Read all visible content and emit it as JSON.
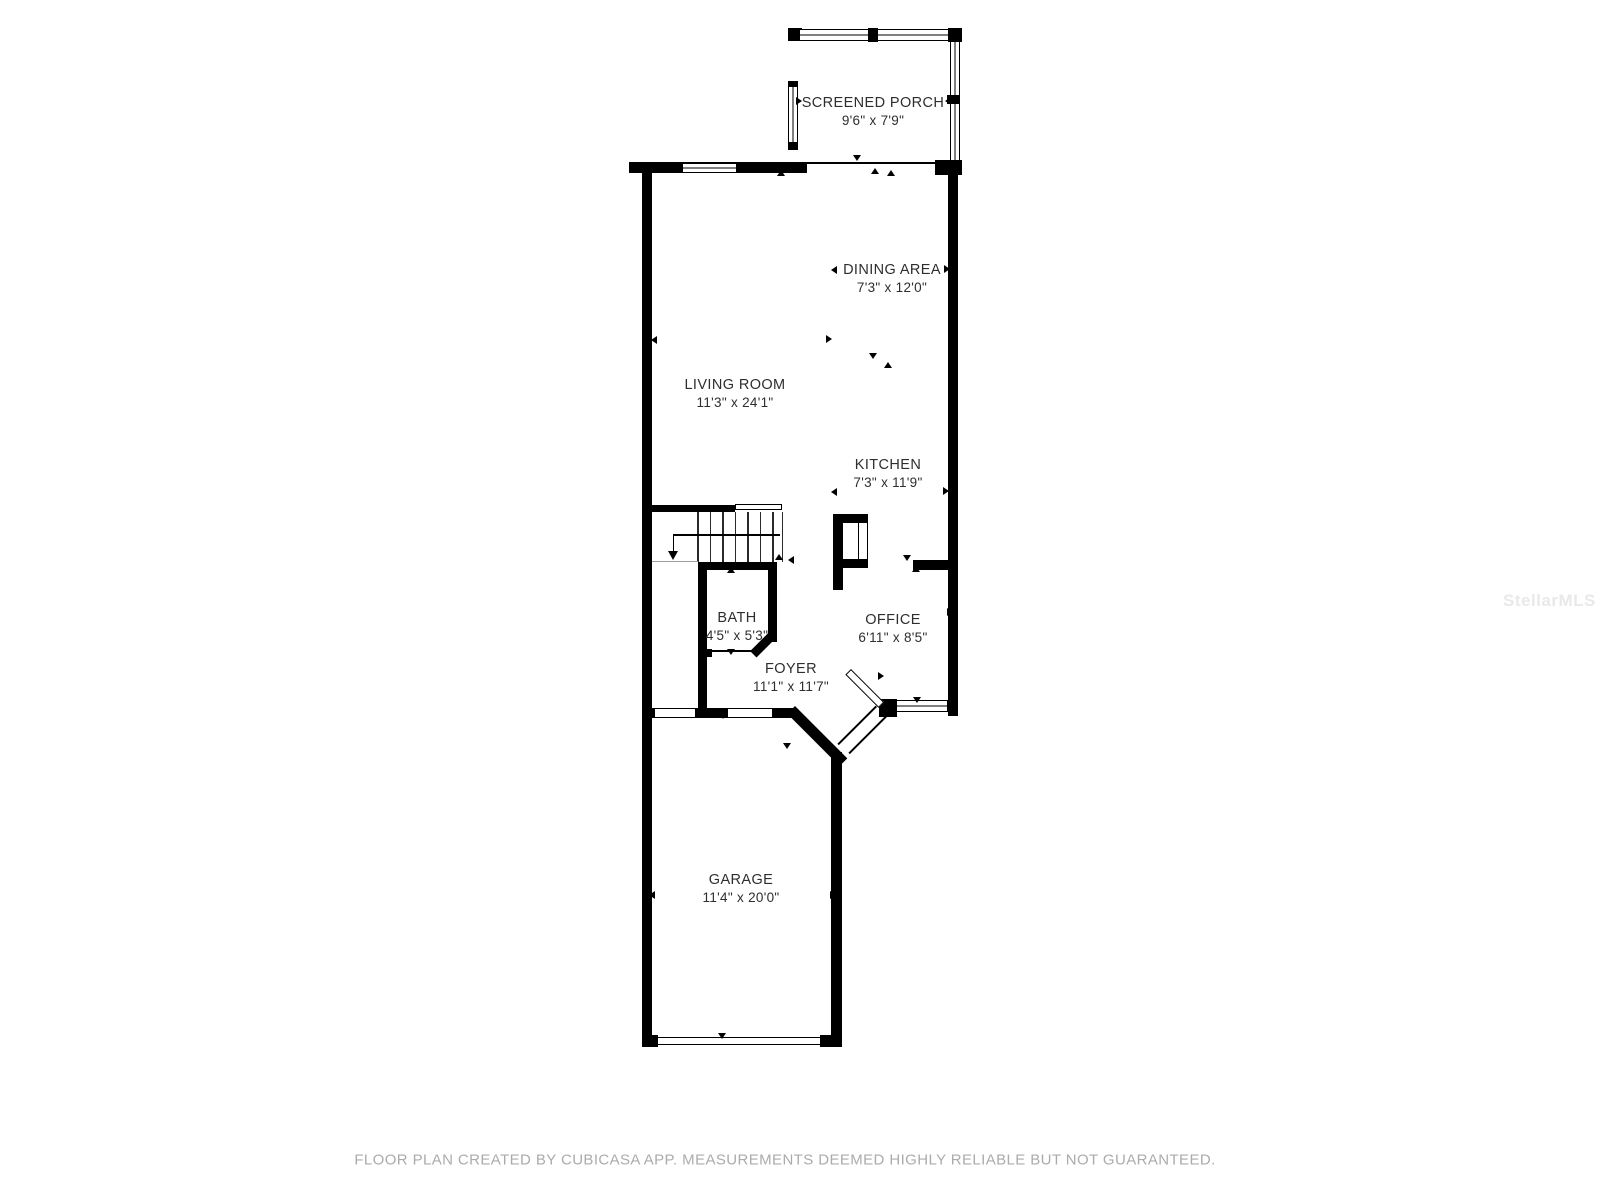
{
  "rooms": [
    {
      "id": "screened-porch",
      "name": "SCREENED PORCH",
      "dims": "9'6\" x 7'9\""
    },
    {
      "id": "dining-area",
      "name": "DINING AREA",
      "dims": "7'3\" x 12'0\""
    },
    {
      "id": "living-room",
      "name": "LIVING ROOM",
      "dims": "11'3\" x 24'1\""
    },
    {
      "id": "kitchen",
      "name": "KITCHEN",
      "dims": "7'3\" x 11'9\""
    },
    {
      "id": "bath",
      "name": "BATH",
      "dims": "4'5\" x 5'3\""
    },
    {
      "id": "office",
      "name": "OFFICE",
      "dims": "6'11\" x 8'5\""
    },
    {
      "id": "foyer",
      "name": "FOYER",
      "dims": "11'1\" x 11'7\""
    },
    {
      "id": "garage",
      "name": "GARAGE",
      "dims": "11'4\" x 20'0\""
    }
  ],
  "watermark": "StellarMLS",
  "footer": "FLOOR PLAN CREATED BY CUBICASA APP. MEASUREMENTS DEEMED HIGHLY RELIABLE BUT NOT GUARANTEED.",
  "colors": {
    "wall": "#000000",
    "label_text": "#2e2e2e",
    "footer_text": "#ababab",
    "watermark_text": "#e9e9e9"
  },
  "markers": [
    {
      "x": 781,
      "y": 173,
      "dir": "up"
    },
    {
      "x": 857,
      "y": 158,
      "dir": "down"
    },
    {
      "x": 875,
      "y": 171,
      "dir": "up"
    },
    {
      "x": 891,
      "y": 173,
      "dir": "up"
    },
    {
      "x": 799,
      "y": 101,
      "dir": "right"
    },
    {
      "x": 948,
      "y": 101,
      "dir": "left"
    },
    {
      "x": 834,
      "y": 270,
      "dir": "left"
    },
    {
      "x": 947,
      "y": 269,
      "dir": "right"
    },
    {
      "x": 654,
      "y": 340,
      "dir": "left"
    },
    {
      "x": 829,
      "y": 339,
      "dir": "right"
    },
    {
      "x": 873,
      "y": 356,
      "dir": "down"
    },
    {
      "x": 888,
      "y": 365,
      "dir": "up"
    },
    {
      "x": 834,
      "y": 492,
      "dir": "left"
    },
    {
      "x": 946,
      "y": 491,
      "dir": "right"
    },
    {
      "x": 779,
      "y": 557,
      "dir": "up"
    },
    {
      "x": 791,
      "y": 560,
      "dir": "left"
    },
    {
      "x": 731,
      "y": 570,
      "dir": "up"
    },
    {
      "x": 731,
      "y": 652,
      "dir": "down"
    },
    {
      "x": 907,
      "y": 558,
      "dir": "down"
    },
    {
      "x": 916,
      "y": 569,
      "dir": "up"
    },
    {
      "x": 950,
      "y": 612,
      "dir": "right"
    },
    {
      "x": 881,
      "y": 676,
      "dir": "right"
    },
    {
      "x": 917,
      "y": 700,
      "dir": "down"
    },
    {
      "x": 723,
      "y": 716,
      "dir": "down"
    },
    {
      "x": 701,
      "y": 677,
      "dir": "left"
    },
    {
      "x": 787,
      "y": 746,
      "dir": "down"
    },
    {
      "x": 652,
      "y": 895,
      "dir": "left"
    },
    {
      "x": 833,
      "y": 895,
      "dir": "right"
    },
    {
      "x": 722,
      "y": 1036,
      "dir": "down"
    }
  ]
}
